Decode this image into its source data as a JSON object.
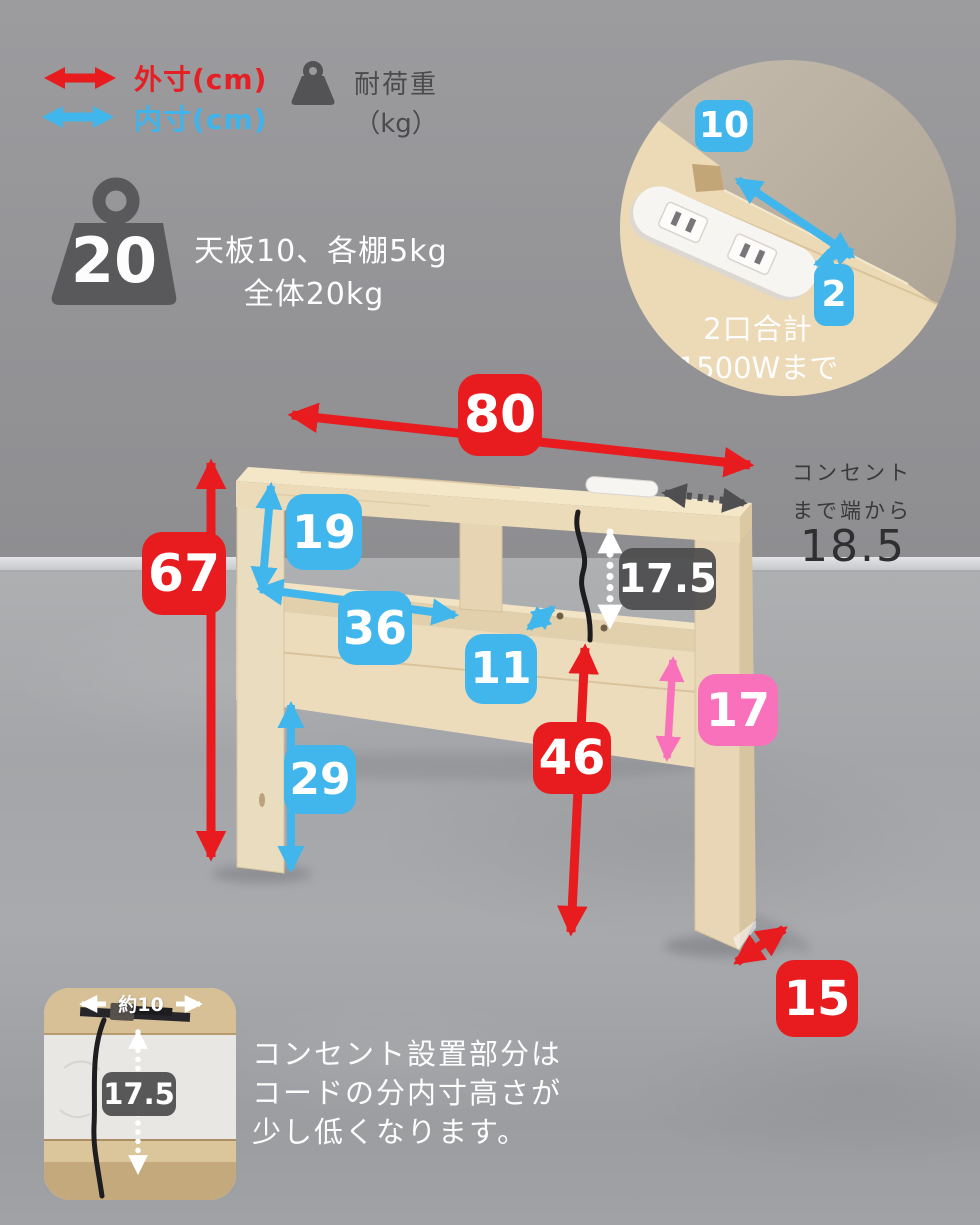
{
  "legend": {
    "outer_label": "外寸(cm)",
    "inner_label": "内寸(cm)",
    "load_label_line1": "耐荷重",
    "load_label_line2": "（kg）"
  },
  "load_spec": {
    "total_badge": "20",
    "desc_line1": "天板10、各棚5kg",
    "desc_line2": "全体20kg"
  },
  "outlet_inset": {
    "width_cm": "10",
    "depth_cm": "2",
    "caption_line1": "2口合計",
    "caption_line2": "1500Wまで"
  },
  "dimensions": {
    "outer_width": "80",
    "outer_height": "67",
    "shelf_inner_height": "19",
    "shelf_inner_width": "36",
    "shelf_depth": "11",
    "outlet_clearance": "17.5",
    "rear_open_height": "46",
    "panel_height": "17",
    "leg_open_height": "29",
    "base_depth": "15"
  },
  "outlet_note": {
    "line1": "コンセント",
    "line2": "まで端から",
    "value": "18.5"
  },
  "cord_inset": {
    "width_label": "約10",
    "height_label": "17.5"
  },
  "footnote": {
    "line1": "コンセント設置部分は",
    "line2": "コードの分内寸高さが",
    "line3": "少し低くなります。"
  },
  "colors": {
    "outer_red": "#e81b1f",
    "inner_blue": "#41b6ec",
    "panel_pink": "#fa71bb",
    "dark_gray": "#4f4f51"
  }
}
